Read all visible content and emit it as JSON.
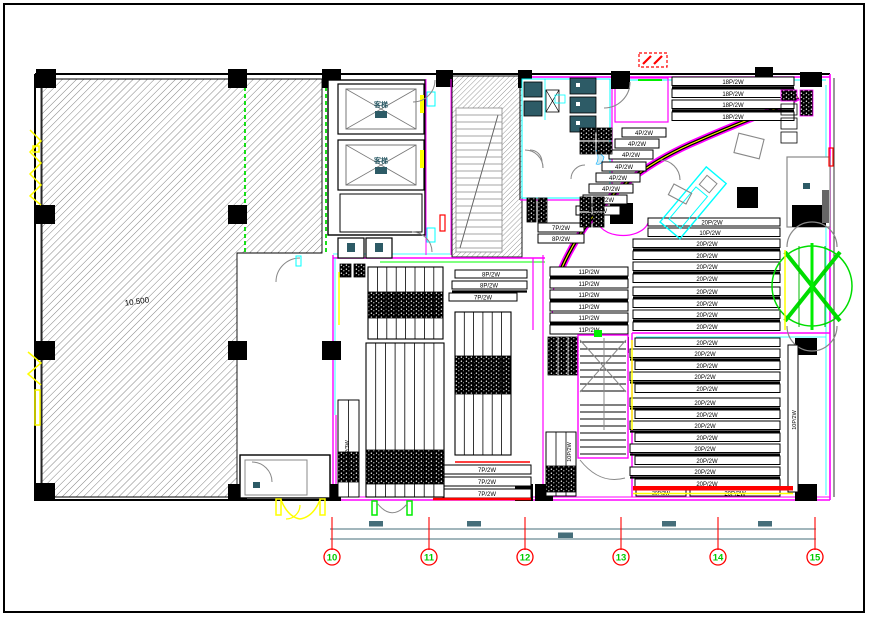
{
  "drawing": {
    "level_text": "10.500",
    "grid": {
      "bubbles": [
        "10",
        "11",
        "12",
        "13",
        "14",
        "15"
      ]
    },
    "core": {
      "elevator_1": "客梯",
      "elevator_2": "客梯"
    },
    "rows": {
      "top_right": [
        "18P/2W",
        "18P/2W",
        "18P/2W",
        "18P/2W"
      ],
      "diag": [
        "4P/2W",
        "4P/2W",
        "4P/2W",
        "4P/2W",
        "4P/2W",
        "4P/2W",
        "4P/2W",
        "4P/2W"
      ],
      "right_upper": [
        "10P/2W",
        "20P/2W",
        "20P/2W",
        "20P/2W",
        "20P/2W",
        "20P/2W",
        "20P/2W",
        "20P/2W",
        "20P/2W",
        "20P/2W"
      ],
      "right_lower": [
        "20P/2W",
        "20P/2W",
        "20P/2W",
        "20P/2W",
        "20P/2W",
        "20P/2W",
        "20P/2W",
        "20P/2W",
        "20P/2W",
        "20P/2W",
        "20P/2W",
        "20P/2W",
        "20P/2W",
        "20P/2W",
        "20P/2W"
      ],
      "center": [
        "11P/2W",
        "11P/2W",
        "11P/2W",
        "11P/2W",
        "11P/2W",
        "11P/2W"
      ],
      "center_small": [
        "8P/2W",
        "8P/2W",
        "7P/2W"
      ],
      "bottom_small": [
        "7P/2W",
        "7P/2W",
        "7P/2W"
      ],
      "mini": [
        "7P/2W",
        "8P/2W"
      ],
      "vertical_a": "10P/2W",
      "vertical_b": "10P/2W",
      "vertical_c": "18P/3W"
    },
    "palette": {
      "wall": "#ff00ff",
      "glass": "#00ffff",
      "axis": "#ff0000",
      "axis_number": "#00cc00",
      "fixture": "#2d5b66",
      "dim_line": "#466e7a",
      "window": "#ffff00",
      "door": "#00ff00"
    }
  }
}
